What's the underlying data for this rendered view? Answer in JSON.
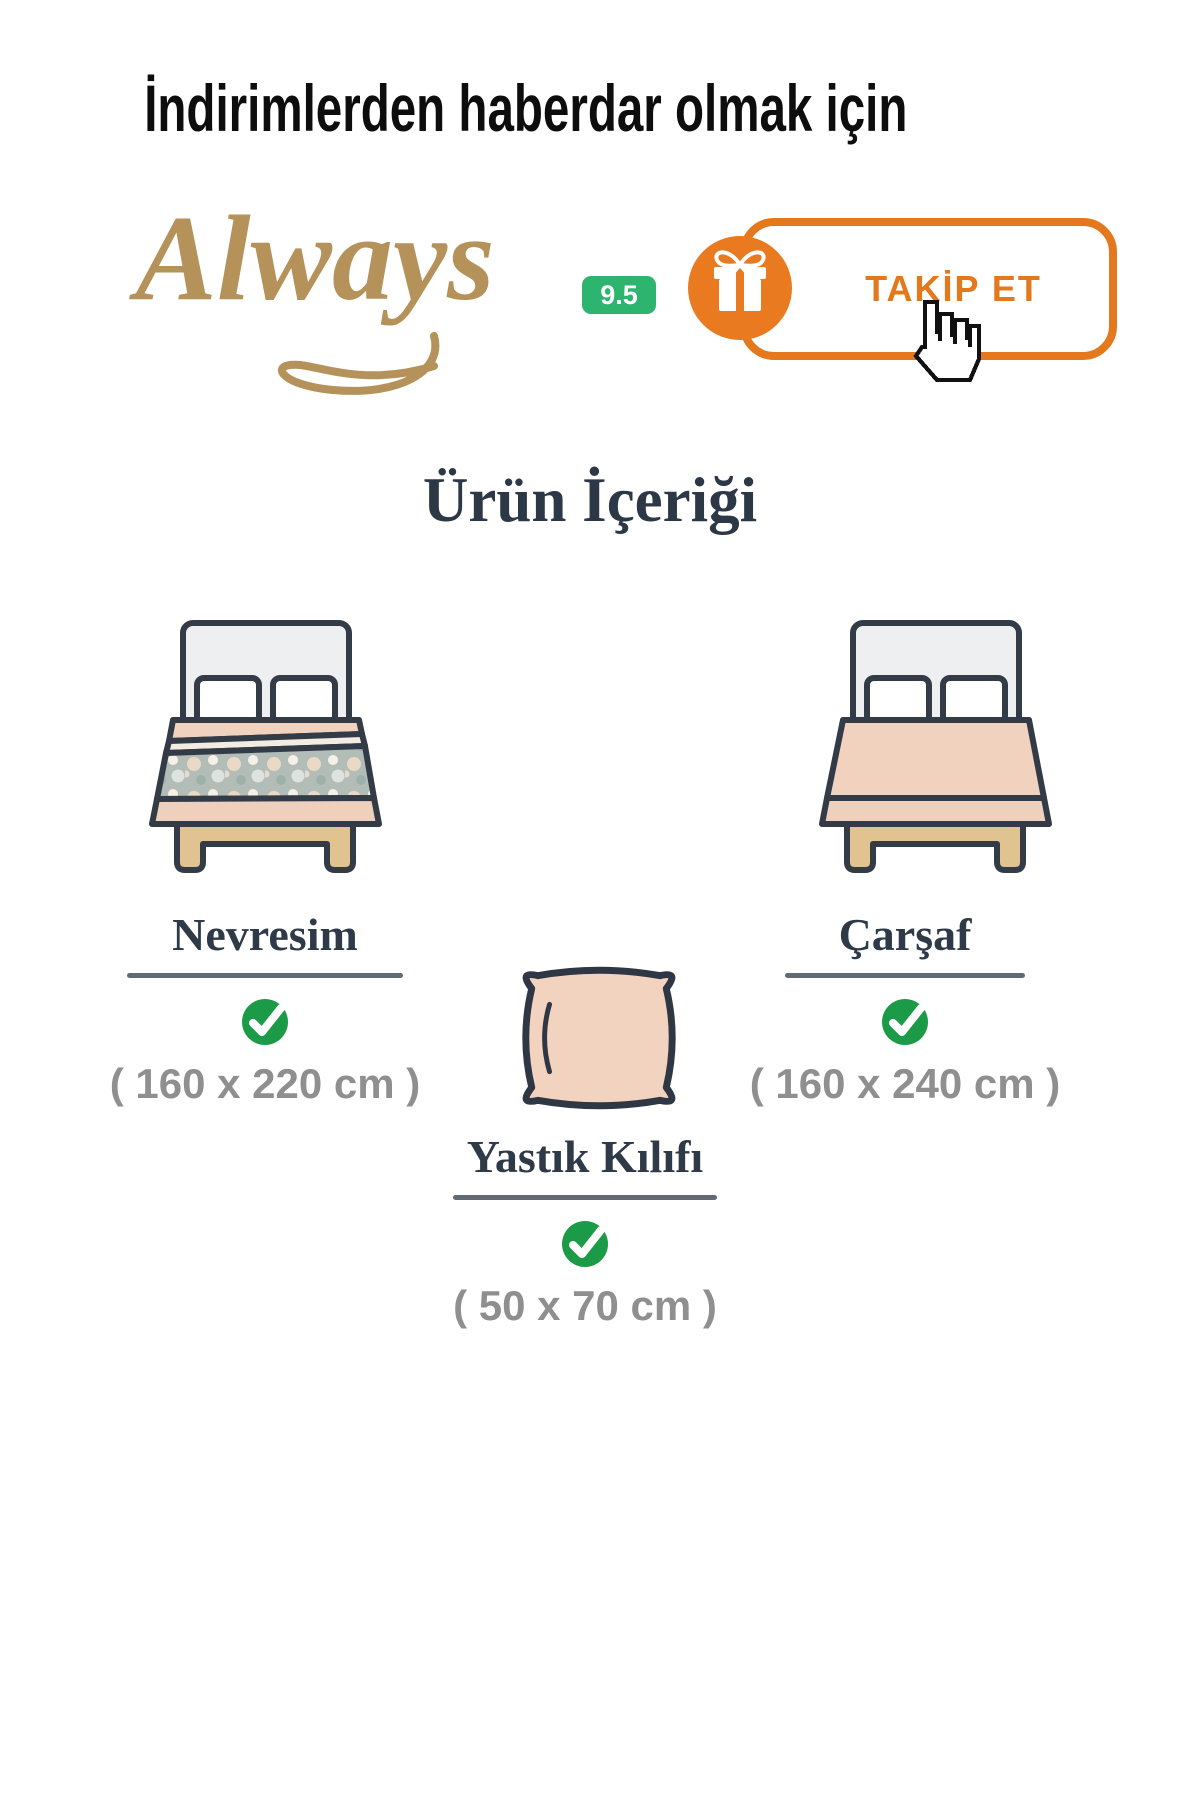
{
  "header": {
    "title": "İndirimlerden haberdar olmak için"
  },
  "brand": {
    "logo_text": "Always",
    "rating_badge": "9.5",
    "follow_button_label": "TAKİP ET"
  },
  "section": {
    "title": "Ürün İçeriği"
  },
  "items": [
    {
      "label": "Nevresim",
      "size": "( 160 x 220 cm )",
      "included": true,
      "illustration": "bed-with-duvet"
    },
    {
      "label": "Çarşaf",
      "size": "( 160 x 240 cm )",
      "included": true,
      "illustration": "bed-with-sheet"
    },
    {
      "label": "Yastık Kılıfı",
      "size": "( 50 x 70 cm )",
      "included": true,
      "illustration": "pillow"
    }
  ],
  "icons": {
    "gift": "gift-icon",
    "check": "check-circle-icon",
    "cursor": "hand-cursor-icon"
  },
  "colors": {
    "brand_gold": "#b5925a",
    "badge_green": "#2db56f",
    "accent_orange": "#e4781d",
    "check_green": "#1b9b47",
    "heading_dark": "#2c3845",
    "size_text_gray": "#8f8f8f",
    "bed_outline": "#333b47"
  }
}
